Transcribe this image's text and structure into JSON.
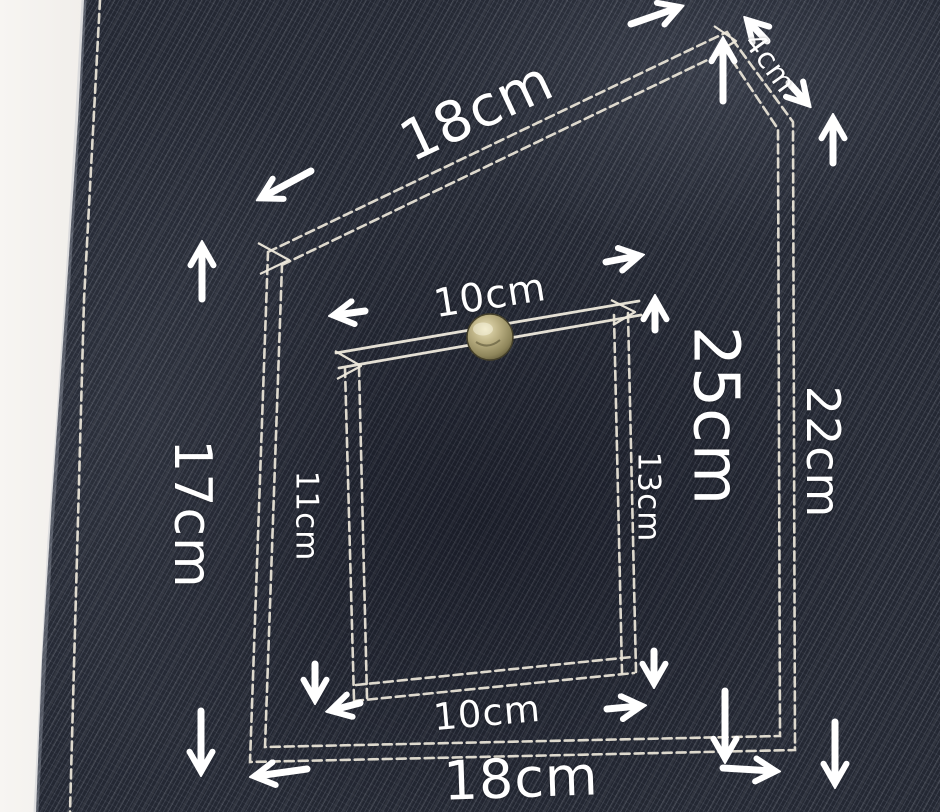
{
  "scene": {
    "description": "Dark indigo denim panel with a stitched pentagon-shaped pocket and an inner buttoned pocket, annotated with sewing measurements",
    "fabric_color": "#242833",
    "stitch_color": "#e8e3d6",
    "annotation_color": "#ffffff",
    "backdrop_color": "#f3f1ee",
    "button_color": "#b3a878"
  },
  "measurements": {
    "outer_top_edge": "18cm",
    "outer_corner_edge": "4cm",
    "outer_right_edge": "22cm",
    "outer_total_height": "25cm",
    "outer_left_edge": "17cm",
    "outer_bottom_edge": "18cm",
    "inner_top_width": "10cm",
    "inner_left_height": "11cm",
    "inner_right_height": "13cm",
    "inner_bottom_width": "10cm"
  }
}
